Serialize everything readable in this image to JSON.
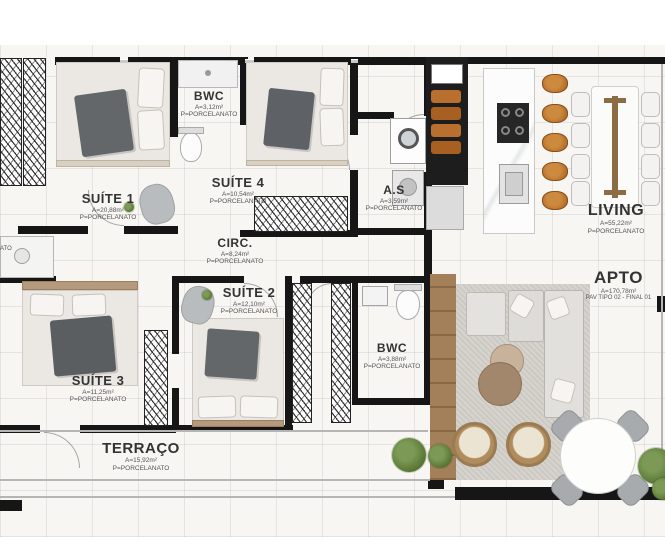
{
  "plan_title": "Planta baixa - apartamento",
  "rooms": {
    "suite1": {
      "name": "SUÍTE 1",
      "area": "A=20,88m²",
      "floor": "P=PORCELANATO"
    },
    "bwc1": {
      "name": "BWC",
      "area": "A=3,12m²",
      "floor": "P=PORCELANATO"
    },
    "suite4": {
      "name": "SUÍTE 4",
      "area": "A=10,54m²",
      "floor": "P=PORCELANATO"
    },
    "as": {
      "name": "A.S",
      "area": "A=3,59m²",
      "floor": "P=PORCELANATO"
    },
    "living": {
      "name": "LIVING",
      "area": "A=55,22m²",
      "floor": "P=PORCELANATO"
    },
    "apto": {
      "name": "APTO",
      "area": "A=170,78m²",
      "floor": "PAV TIPO 02 - FINAL 01"
    },
    "circ": {
      "name": "CIRC.",
      "area": "A=8,24m²",
      "floor": "P=PORCELANATO"
    },
    "suite2": {
      "name": "SUÍTE 2",
      "area": "A=12,10m²",
      "floor": "P=PORCELANATO"
    },
    "suite3": {
      "name": "SUÍTE 3",
      "area": "A=11,25m²",
      "floor": "P=PORCELANATO"
    },
    "bwc2": {
      "name": "BWC",
      "area": "A=3,88m²",
      "floor": "P=PORCELANATO"
    },
    "terraco": {
      "name": "TERRAÇO",
      "area": "A=15,92m²",
      "floor": "P=PORCELANATO"
    },
    "edge_cut": {
      "floor": "ATO"
    }
  },
  "colors": {
    "wall": "#161616",
    "wood": "#9c7b55",
    "stool_brown": "#b5722f",
    "plant_green": "#5f7d3f",
    "floor_tile": "#f7f6f3"
  }
}
